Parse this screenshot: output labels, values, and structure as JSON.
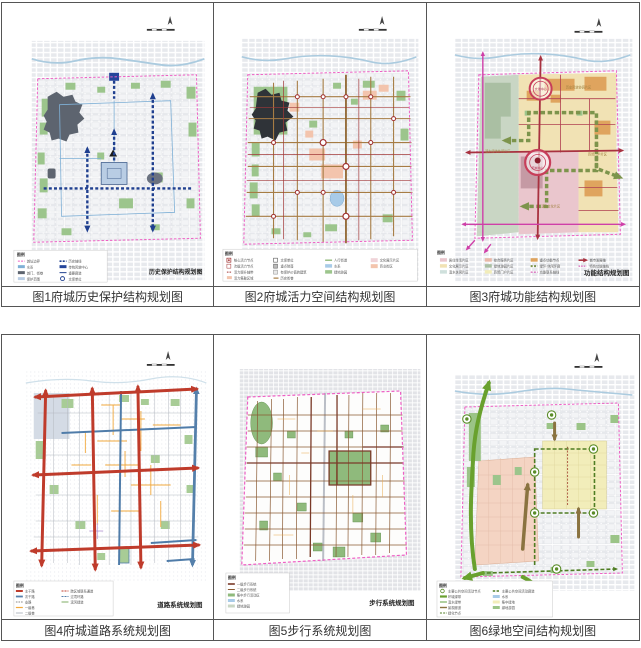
{
  "colors": {
    "boundary_magenta": "#ee5fc4",
    "heritage_axis_navy": "#1f3f8f",
    "vitality_brown": "#a67c44",
    "function_axis_red": "#a83240",
    "axis_magenta": "#cf3fa8",
    "road_major_red": "#bf3b2b",
    "road_secondary_blue": "#4f7ca9",
    "road_minor_orange": "#f2a93c",
    "pedestrian_brown": "#8a5a33",
    "green_ribbon": "#69a12e",
    "green_patch": "#9cc58c",
    "zone_beige": "#f1e2b4",
    "zone_pink": "#eac6cd",
    "zone_salmon": "#f3d3c2",
    "zone_yellow": "#f2edba",
    "zone_sage": "#c9d6c4",
    "water_blue": "#a8cbe8"
  },
  "panels": [
    {
      "caption": "图1府城历史保护结构规划图",
      "map_label": "历史保护结构规划图",
      "legend_title": "图例",
      "legend": [
        "城址边界",
        "水系",
        "城门、街巷",
        "保护范围",
        "历史轴线",
        "传统风貌中心",
        "重要廊道",
        "文保单位"
      ]
    },
    {
      "caption": "图2府城活力空间结构规划图",
      "map_label": "",
      "legend_title": "图例",
      "legend": [
        "核心活力节点",
        "次级活力节点",
        "活力提升轴带",
        "活力集聚区域",
        "文保单位",
        "重点院落",
        "有保护价值的建筑",
        "历史街巷",
        "人行街道",
        "水系",
        "绿地游园",
        "文化展示片区",
        "商业街区"
      ]
    },
    {
      "caption": "图3府城功能结构规划图",
      "map_label": "功能结构规划图",
      "legend_title": "图例",
      "legend": [
        "居住生活片区",
        "文化展示片区",
        "滨水休闲片区",
        "综合服务片区",
        "绿地游园片区",
        "商贸门户片区",
        "重点功能节点",
        "绿环·休闲环廊",
        "功能联系轴线",
        "城市发展轴",
        "特色功能轴线"
      ],
      "circle_labels": [
        "文化中心",
        "府城中心"
      ],
      "zone_labels": [
        "历史风貌协调片区",
        "商贸门户片区",
        "滨水文化片区",
        "滨水绿地休闲片区"
      ]
    },
    {
      "caption": "图4府城道路系统规划图",
      "map_label": "道路系统规划图",
      "legend_title": "图例",
      "legend": [
        "主干路",
        "次干路",
        "支路",
        "一级巷",
        "二级巷",
        "跨区域联系通道",
        "过境环路",
        "滨河绿道"
      ]
    },
    {
      "caption": "图5步行系统规划图",
      "map_label": "步行系统规划图",
      "legend_title": "图例",
      "legend": [
        "一级步行系统",
        "二级步行系统",
        "集中步行活动区",
        "水系",
        "绿地游园"
      ]
    },
    {
      "caption": "图6绿地空间结构规划图",
      "map_label": "",
      "legend_title": "图例",
      "legend": [
        "主要公共空间活动节点",
        "环城绿带",
        "滨水绿带",
        "景观廊道",
        "绿化节点",
        "主要公共空间活动廊道",
        "水系",
        "集中绿地",
        "绿地游园"
      ]
    }
  ]
}
